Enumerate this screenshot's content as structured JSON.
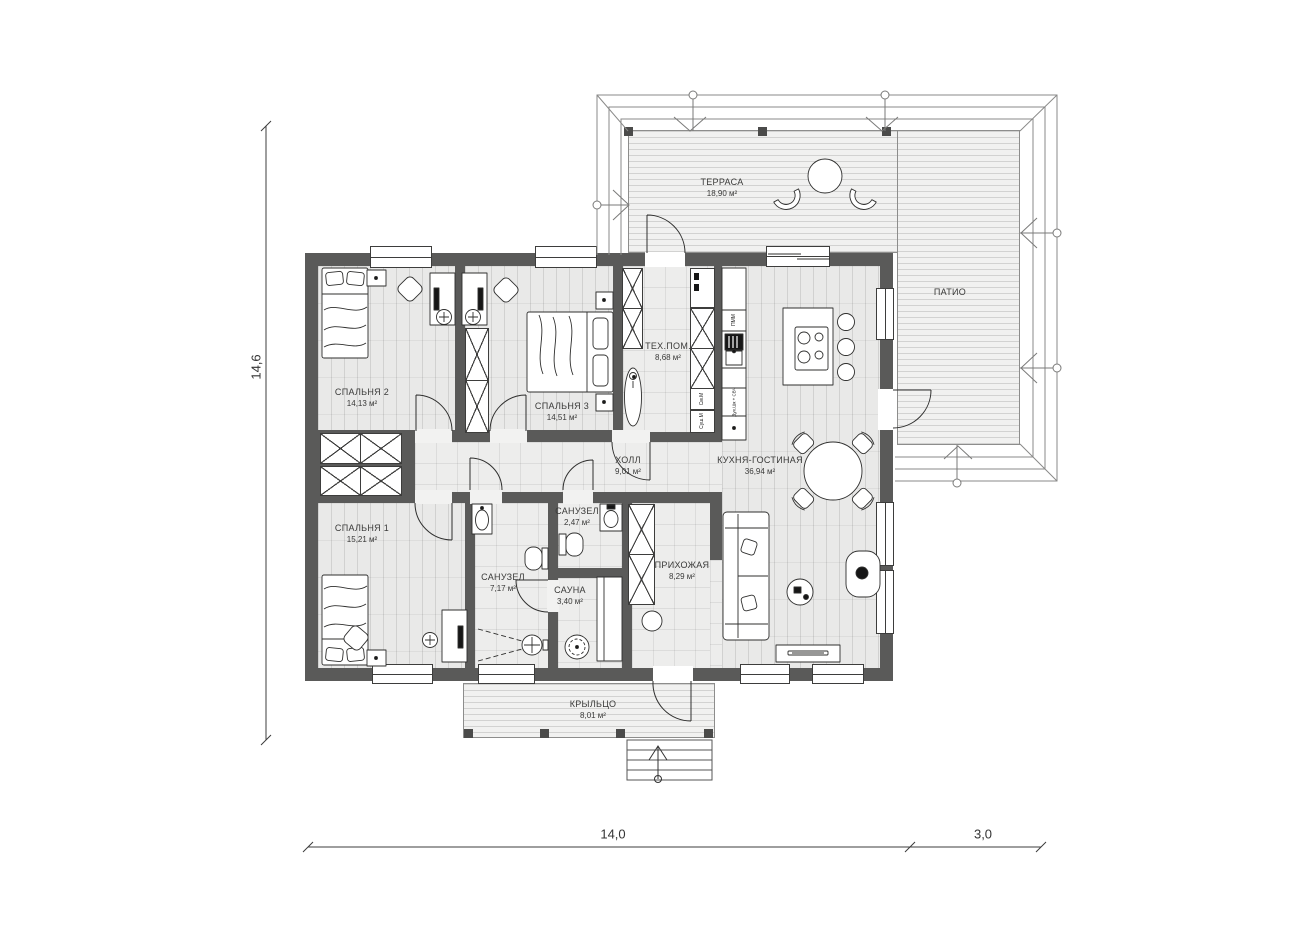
{
  "rooms": {
    "terrace": {
      "name": "ТЕРРАСА",
      "area": "18,90 м²"
    },
    "patio": {
      "name": "ПАТИО"
    },
    "bedroom2": {
      "name": "СПАЛЬНЯ 2",
      "area": "14,13 м²"
    },
    "bedroom3": {
      "name": "СПАЛЬНЯ 3",
      "area": "14,51 м²"
    },
    "tech": {
      "name": "ТЕХ.ПОМ.",
      "area": "8,68 м²"
    },
    "kitchen_living": {
      "name": "КУХНЯ-ГОСТИНАЯ",
      "area": "36,94 м²"
    },
    "hall": {
      "name": "ХОЛЛ",
      "area": "9,01 м²"
    },
    "bedroom1": {
      "name": "СПАЛЬНЯ 1",
      "area": "15,21 м²"
    },
    "bathroom": {
      "name": "САНУЗЕЛ",
      "area": "7,17 м²"
    },
    "wc": {
      "name": "САНУЗЕЛ",
      "area": "2,47 м²"
    },
    "sauna": {
      "name": "САУНА",
      "area": "3,40 м²"
    },
    "entry": {
      "name": "ПРИХОЖАЯ",
      "area": "8,29 м²"
    },
    "porch": {
      "name": "КРЫЛЬЦО",
      "area": "8,01 м²"
    }
  },
  "appliances": {
    "dishwasher": "ПММ",
    "washer": "См.М",
    "dryer": "Суш.М",
    "oven_microwave": "Дух.Шк + СВЧ"
  },
  "dimensions": {
    "left_height": "14,6",
    "bottom_width": "14,0",
    "bottom_patio": "3,0"
  },
  "colors": {
    "wall": "#5a5a59",
    "floor": "#e9e9e8",
    "deck": "#f1f1f0",
    "line": "#2f2f2e"
  }
}
